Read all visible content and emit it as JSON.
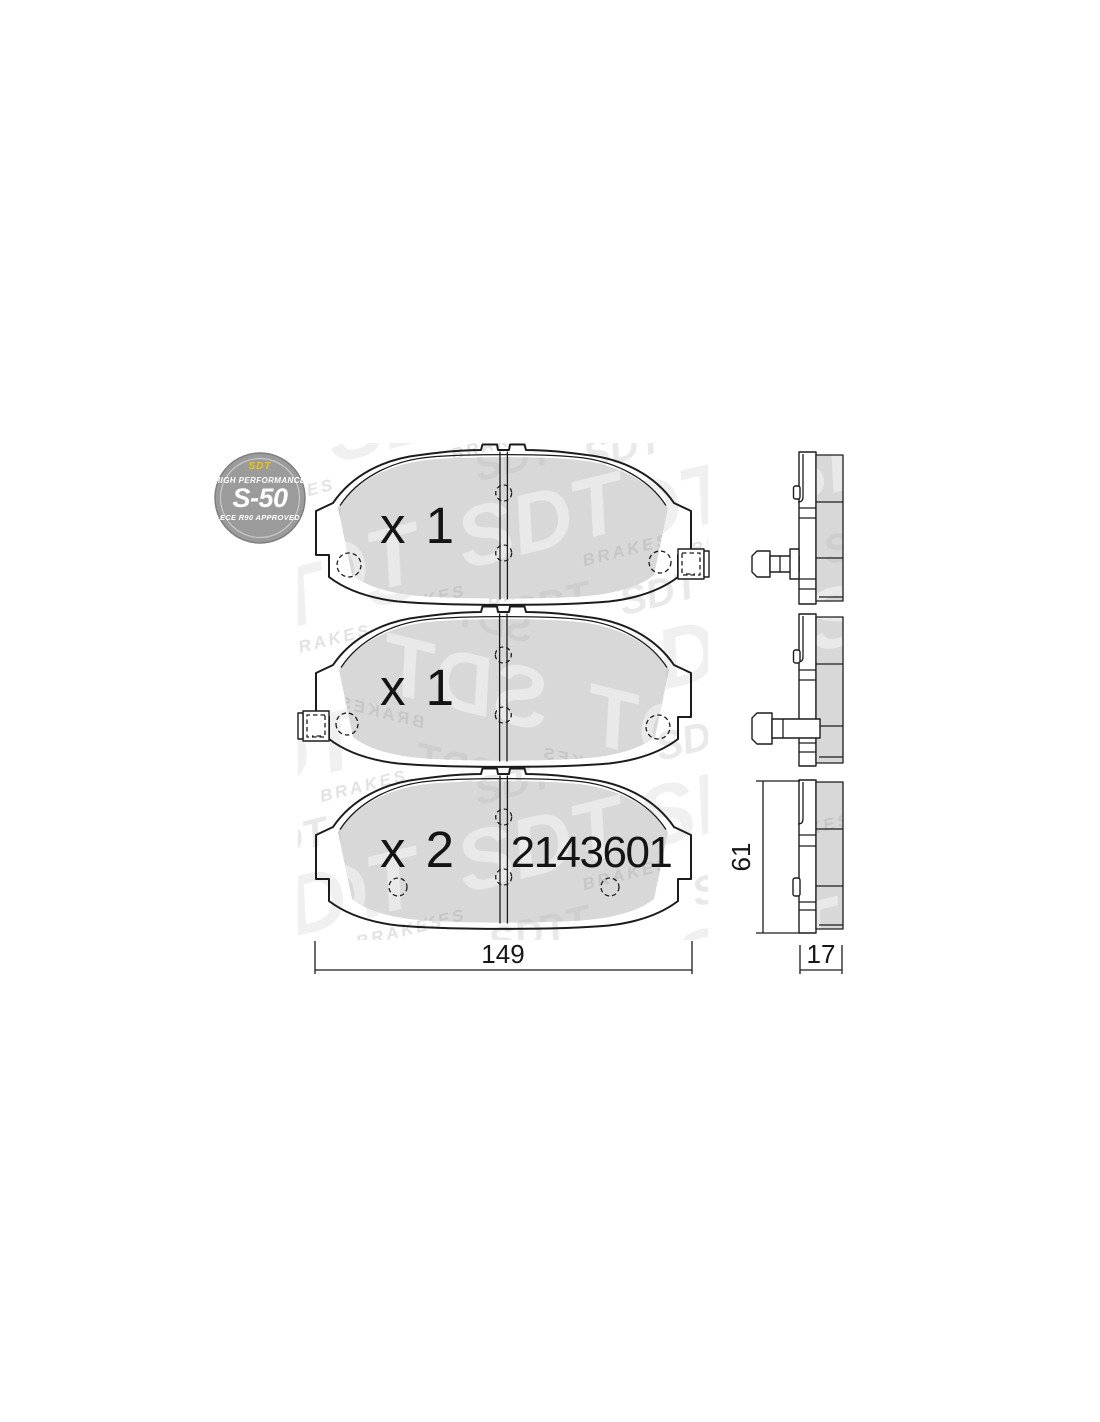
{
  "badge": {
    "brand": "SDT",
    "tagline": "HIGH PERFORMANCE",
    "model": "S-50",
    "certification": "ECE R90 APPROVED"
  },
  "watermark": {
    "brand": "SDT",
    "word": "BRAKES"
  },
  "pads": [
    {
      "id": "pad-1",
      "quantity": "x 1"
    },
    {
      "id": "pad-2",
      "quantity": "x 1"
    },
    {
      "id": "pad-3",
      "quantity": "x 2",
      "part_number": "2143601"
    }
  ],
  "dimensions": {
    "length": "149",
    "height": "61",
    "thickness": "17"
  },
  "colors": {
    "line": "#1c1c1c",
    "friction_material": "#d8d8d8",
    "watermark_on_gray_light": "#e9e9e9",
    "watermark_on_gray_dark": "#c6c6c6",
    "watermark_on_white": "#f1f1f1",
    "badge_bg": "#9b9b9b",
    "badge_text": "#ffffff",
    "badge_accent": "#eec500"
  }
}
